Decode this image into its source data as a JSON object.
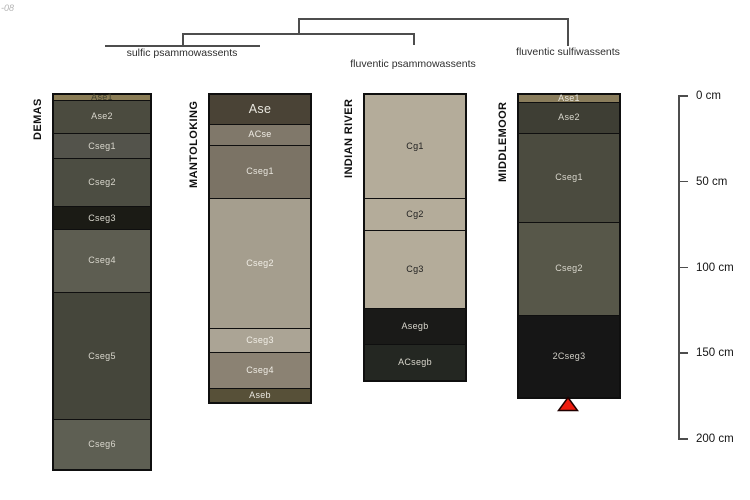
{
  "watermark": "-08",
  "tree": {
    "sulfic": "sulfic psammowassents",
    "fluventic_psamm": "fluventic psammowassents",
    "fluventic_sulf": "fluventic sulfiwassents"
  },
  "scale": {
    "unit": "cm",
    "y0_px": 95,
    "px_per_cm": 1.715,
    "ticks": [
      {
        "label": "0 cm",
        "cm": 0
      },
      {
        "label": "50 cm",
        "cm": 50
      },
      {
        "label": "100 cm",
        "cm": 100
      },
      {
        "label": "150 cm",
        "cm": 150
      },
      {
        "label": "200 cm",
        "cm": 200
      }
    ]
  },
  "columns": [
    {
      "name": "DEMAS",
      "group": "sulfic psammowassents",
      "x_px": 52,
      "width_px": 96,
      "title_len_px": 47,
      "horizons": [
        {
          "label": "Ase1",
          "depth_cm": [
            0,
            3
          ],
          "color": "#8a7c55",
          "text_color": "#3f3f2f"
        },
        {
          "label": "Ase2",
          "depth_cm": [
            3,
            22
          ],
          "color": "#4b4b3f",
          "text_color": "#d8d6cc"
        },
        {
          "label": "Cseg1",
          "depth_cm": [
            22,
            37
          ],
          "color": "#53534b",
          "text_color": "#d8d6cc"
        },
        {
          "label": "Cseg2",
          "depth_cm": [
            37,
            65
          ],
          "color": "#4c4d42",
          "text_color": "#d8d6cc"
        },
        {
          "label": "Cseg3",
          "depth_cm": [
            65,
            78
          ],
          "color": "#1b1b15",
          "text_color": "#d8d6cc"
        },
        {
          "label": "Cseg4",
          "depth_cm": [
            78,
            115
          ],
          "color": "#5d5d51",
          "text_color": "#d8d6cc"
        },
        {
          "label": "Cseg5",
          "depth_cm": [
            115,
            189
          ],
          "color": "#45463b",
          "text_color": "#d8d6cc"
        },
        {
          "label": "Cseg6",
          "depth_cm": [
            189,
            218
          ],
          "color": "#5e5f53",
          "text_color": "#d8d6cc"
        }
      ]
    },
    {
      "name": "MANTOLOKING",
      "group": "sulfic psammowassents",
      "x_px": 208,
      "width_px": 100,
      "title_len_px": 95,
      "horizons": [
        {
          "label": "Ase",
          "depth_cm": [
            0,
            17
          ],
          "color": "#4a4336",
          "text_color": "#e8e6de",
          "big": true
        },
        {
          "label": "ACse",
          "depth_cm": [
            17,
            29
          ],
          "color": "#80786a",
          "text_color": "#efece4"
        },
        {
          "label": "Cseg1",
          "depth_cm": [
            29,
            60
          ],
          "color": "#7b7365",
          "text_color": "#e8e5dd"
        },
        {
          "label": "Cseg2",
          "depth_cm": [
            60,
            136
          ],
          "color": "#a59e8e",
          "text_color": "#f0ede5"
        },
        {
          "label": "Cseg3",
          "depth_cm": [
            136,
            150
          ],
          "color": "#aba495",
          "text_color": "#f0ede5"
        },
        {
          "label": "Cseg4",
          "depth_cm": [
            150,
            171
          ],
          "color": "#8b8273",
          "text_color": "#eeebe3"
        },
        {
          "label": "Aseb",
          "depth_cm": [
            171,
            179
          ],
          "color": "#575038",
          "text_color": "#e8e6de"
        }
      ]
    },
    {
      "name": "INDIAN RIVER",
      "group": "fluventic psammowassents",
      "x_px": 363,
      "width_px": 100,
      "title_len_px": 85,
      "horizons": [
        {
          "label": "Cg1",
          "depth_cm": [
            0,
            60
          ],
          "color": "#b4ac9a",
          "text_color": "#1f1f1f"
        },
        {
          "label": "Cg2",
          "depth_cm": [
            60,
            79
          ],
          "color": "#b4ac9a",
          "text_color": "#1f1f1f"
        },
        {
          "label": "Cg3",
          "depth_cm": [
            79,
            124
          ],
          "color": "#b4ac9a",
          "text_color": "#1f1f1f"
        },
        {
          "label": "Asegb",
          "depth_cm": [
            124,
            145
          ],
          "color": "#1a1a18",
          "text_color": "#d8d6cc"
        },
        {
          "label": "ACsegb",
          "depth_cm": [
            145,
            166
          ],
          "color": "#242722",
          "text_color": "#d8d6cc"
        }
      ]
    },
    {
      "name": "MIDDLEMOOR",
      "group": "fluventic sulfiwassents",
      "x_px": 517,
      "width_px": 100,
      "title_len_px": 89,
      "horizons": [
        {
          "label": "Ase1",
          "depth_cm": [
            0,
            4
          ],
          "color": "#8a7d5c",
          "text_color": "#e8e6de"
        },
        {
          "label": "Ase2",
          "depth_cm": [
            4,
            22
          ],
          "color": "#3e3e34",
          "text_color": "#d8d6cc"
        },
        {
          "label": "Cseg1",
          "depth_cm": [
            22,
            74
          ],
          "color": "#4b4b3f",
          "text_color": "#d8d6cc"
        },
        {
          "label": "Cseg2",
          "depth_cm": [
            74,
            128
          ],
          "color": "#575749",
          "text_color": "#d8d6cc"
        },
        {
          "label": "2Cseg3",
          "depth_cm": [
            128,
            176
          ],
          "color": "#161616",
          "text_color": "#cfcdc5"
        }
      ]
    }
  ],
  "marker": {
    "symbol": "red-triangle",
    "color": "#ee1c0f",
    "outline_color": "#200000",
    "below_column": "MIDDLEMOOR"
  }
}
